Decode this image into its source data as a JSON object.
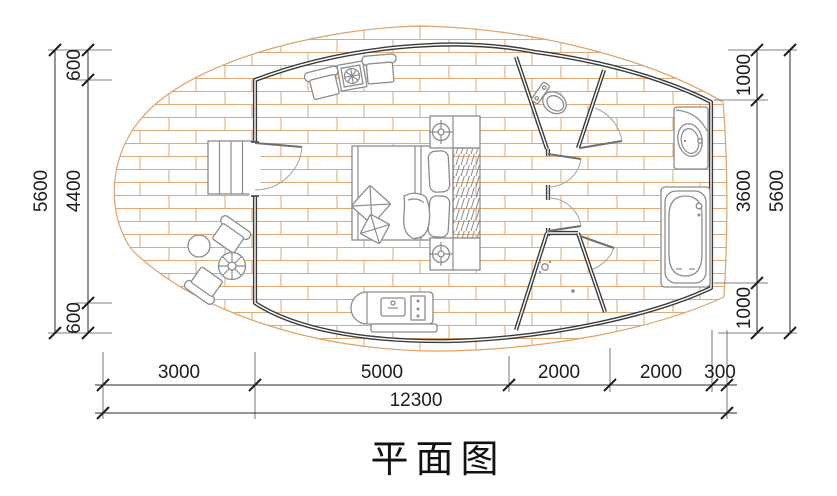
{
  "title": "平面图",
  "dimensions": {
    "left": {
      "overall": "5600",
      "segments": [
        "600",
        "4400",
        "600"
      ]
    },
    "right": {
      "overall": "5600",
      "segments": [
        "1000",
        "3600",
        "1000"
      ]
    },
    "bottom": {
      "overall": "12300",
      "segments": [
        "3000",
        "5000",
        "2000",
        "2000",
        "300"
      ]
    }
  },
  "colors": {
    "wall_line": "#3a3a3a",
    "furniture_line": "#8c8c8c",
    "deck_hatch": "#dfa36b",
    "dimension_line": "#2b2b2b",
    "background": "#ffffff"
  },
  "icons": {
    "deck": "brick-paving-hatch",
    "entry": "entry-stairs-icon",
    "outdoor": [
      "outdoor-armchair-icon",
      "round-side-table-icon",
      "parasol-table-icon",
      "outdoor-armchair-icon"
    ],
    "bedroom": [
      "lounge-armchair-icon",
      "plant-table-icon",
      "lounge-armchair-icon",
      "double-bed-icon",
      "nightstand-lamp-icon",
      "wardrobe-hangers-icon",
      "nightstand-lamp-icon",
      "kitchenette-counter-icon"
    ],
    "bathroom": [
      "toilet-icon",
      "shower-head-icon",
      "washbasin-vanity-icon",
      "bathtub-icon"
    ]
  }
}
